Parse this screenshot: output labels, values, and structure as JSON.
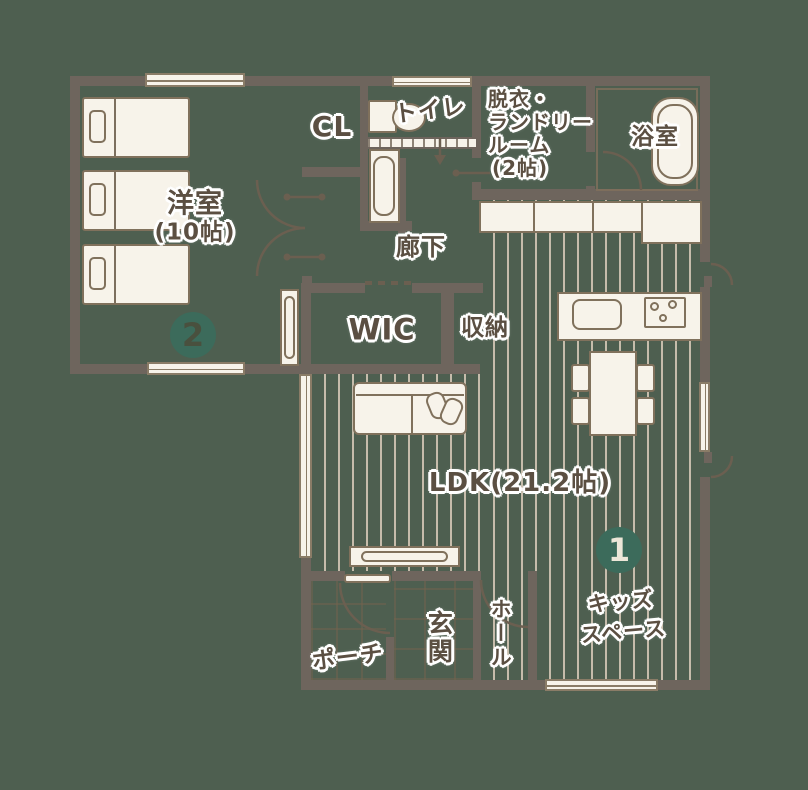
{
  "title": "1F floor plan",
  "colors": {
    "background": "#4e5f50",
    "wall": "#6e655d",
    "fixture_fill": "#f7f3ea",
    "outline": "#80715c",
    "accent_teal": "#3c6b5b",
    "label_text": "#5b4f42",
    "floor_stripe": "#c6bcab"
  },
  "rooms": {
    "bedroom": {
      "name": "洋室",
      "size": "(10帖)"
    },
    "closet": {
      "name": "CL"
    },
    "toilet": {
      "name": "トイレ"
    },
    "laundry": {
      "line1": "脱衣・",
      "line2": "ランドリー",
      "line3": "ルーム",
      "line4": "(2帖)"
    },
    "bath": {
      "name": "浴室"
    },
    "corridor": {
      "name": "廊下"
    },
    "wic": {
      "name": "WIC"
    },
    "storage": {
      "name": "収納"
    },
    "ldk": {
      "name": "LDK(21.2帖)"
    },
    "kids": {
      "line1": "キッズ",
      "line2": "スペース"
    },
    "porch": {
      "name": "ポーチ"
    },
    "entrance": {
      "name": "玄関"
    },
    "hall": {
      "name": "ホール"
    }
  },
  "markers": {
    "bedroom": "2",
    "kids": "1"
  }
}
